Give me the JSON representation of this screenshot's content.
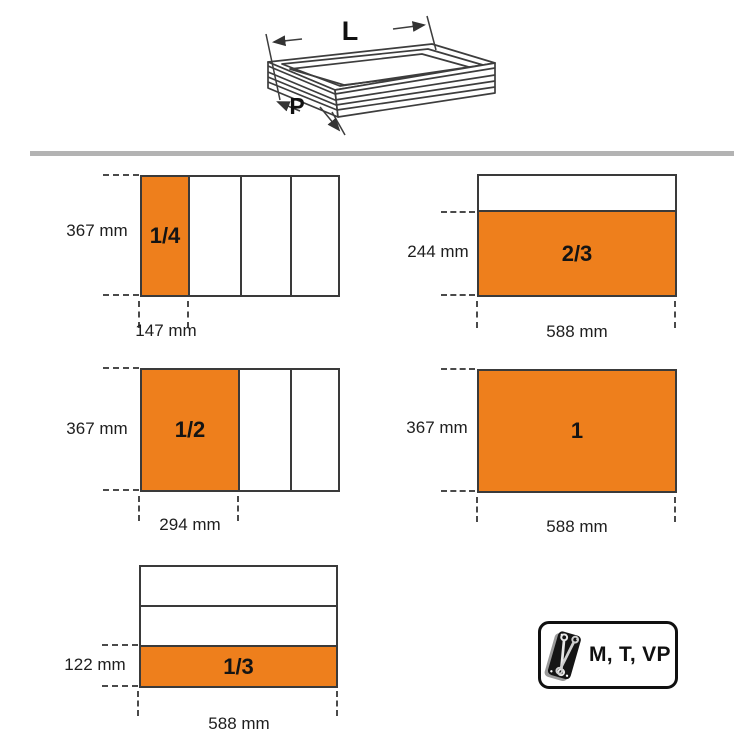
{
  "drawer_illustration": {
    "length_label": "L",
    "depth_label": "P"
  },
  "diagrams": [
    {
      "name": "drawer-1-4",
      "fraction": "1/4",
      "height": "367 mm",
      "width": "147 mm"
    },
    {
      "name": "drawer-2-3",
      "fraction": "2/3",
      "height": "244 mm",
      "width": "588 mm"
    },
    {
      "name": "drawer-1-2",
      "fraction": "1/2",
      "height": "367 mm",
      "width": "294 mm"
    },
    {
      "name": "drawer-1",
      "fraction": "1",
      "height": "367 mm",
      "width": "588 mm"
    },
    {
      "name": "drawer-1-3",
      "fraction": "1/3",
      "height": "122 mm",
      "width": "588 mm"
    }
  ],
  "badge": {
    "label": "M, T, VP",
    "icon": "wrench-tray-icon"
  },
  "colors": {
    "accent_orange": "#ee7f1c",
    "line": "#3a3a3a",
    "separator": "#b3b3b3"
  }
}
